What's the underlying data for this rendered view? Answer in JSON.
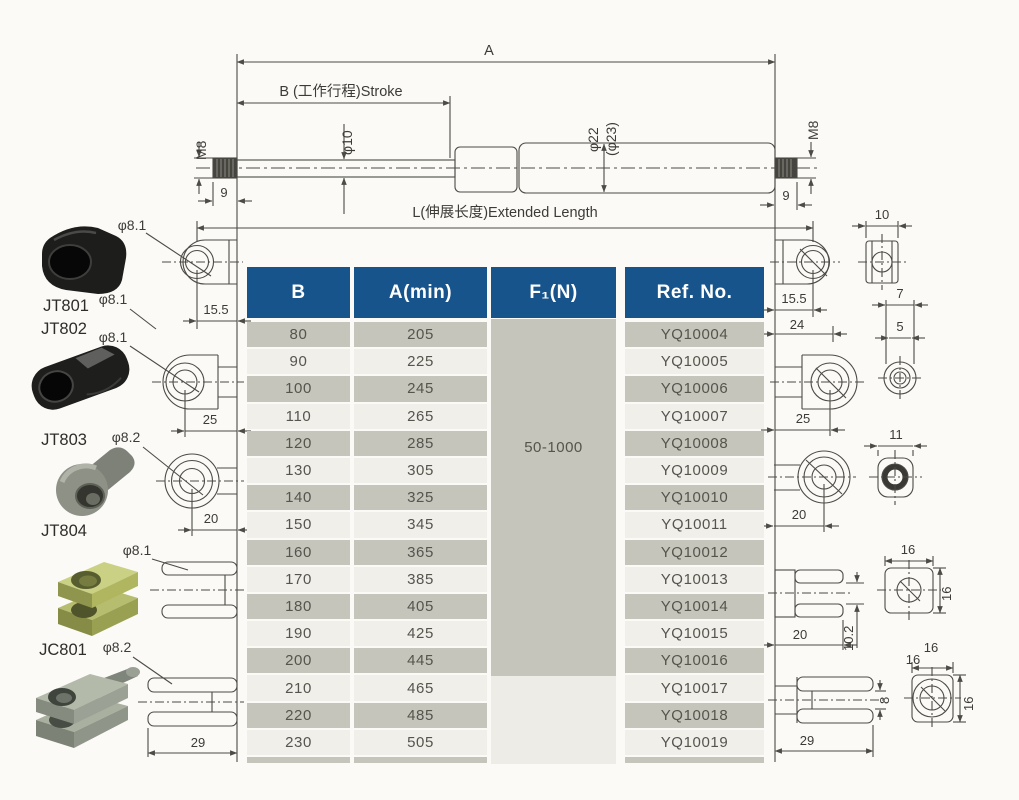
{
  "spring": {
    "dim_a": "A",
    "dim_b": "B (工作行程)Stroke",
    "dim_l": "L(伸展长度)Extended Length",
    "rod_dia": "φ10",
    "tube_dia": "φ22",
    "tube_dia_alt": "(φ23)",
    "thread_left": "M8",
    "thread_right": "M8",
    "thread_len_left": "9",
    "thread_len_right": "9"
  },
  "left": {
    "top_hole_dia": "φ8.1",
    "eyelet_width": "15.5",
    "jt801": {
      "label": "JT801",
      "dia": "φ8.1"
    },
    "jt802": {
      "label": "JT802",
      "dia": "φ8.1",
      "len": "25"
    },
    "jt803": {
      "label": "JT803",
      "dia": "φ8.2",
      "len": "20"
    },
    "jt804": {
      "label": "JT804",
      "dia": "φ8.1"
    },
    "jc801": {
      "label": "JC801",
      "dia": "φ8.2",
      "len": "29"
    }
  },
  "right": {
    "eyelet_width": "15.5",
    "block_width": "10",
    "eyelet_len": "24",
    "eyelet2_len": "25",
    "stud_flat": "7",
    "stud_dia": "5",
    "ball_len": "20",
    "ball_block": "11",
    "clevis_len": "20",
    "clevis_slot": "10.2",
    "sq_w": "16",
    "sq_h": "16",
    "big_clevis_len": "29",
    "big_slot": "8",
    "big_sq_w1": "16",
    "big_sq_w2": "16",
    "big_sq_h": "16"
  },
  "table": {
    "headers": {
      "b": "B",
      "a": "A(min)",
      "f": "F₁(N)",
      "ref": "Ref. No."
    },
    "force_range": "50-1000",
    "rows": [
      {
        "b": "80",
        "a": "205",
        "ref": "YQ10004"
      },
      {
        "b": "90",
        "a": "225",
        "ref": "YQ10005"
      },
      {
        "b": "100",
        "a": "245",
        "ref": "YQ10006"
      },
      {
        "b": "110",
        "a": "265",
        "ref": "YQ10007"
      },
      {
        "b": "120",
        "a": "285",
        "ref": "YQ10008"
      },
      {
        "b": "130",
        "a": "305",
        "ref": "YQ10009"
      },
      {
        "b": "140",
        "a": "325",
        "ref": "YQ10010"
      },
      {
        "b": "150",
        "a": "345",
        "ref": "YQ10011"
      },
      {
        "b": "160",
        "a": "365",
        "ref": "YQ10012"
      },
      {
        "b": "170",
        "a": "385",
        "ref": "YQ10013"
      },
      {
        "b": "180",
        "a": "405",
        "ref": "YQ10014"
      },
      {
        "b": "190",
        "a": "425",
        "ref": "YQ10015"
      },
      {
        "b": "200",
        "a": "445",
        "ref": "YQ10016"
      },
      {
        "b": "210",
        "a": "465",
        "ref": "YQ10017"
      },
      {
        "b": "220",
        "a": "485",
        "ref": "YQ10018"
      },
      {
        "b": "230",
        "a": "505",
        "ref": "YQ10019"
      }
    ]
  }
}
